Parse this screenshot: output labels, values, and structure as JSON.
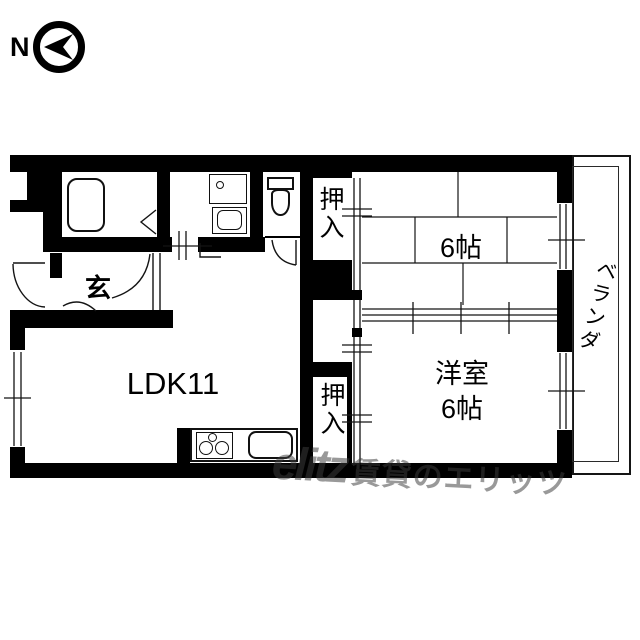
{
  "compass": {
    "north_label": "N"
  },
  "floorplan": {
    "rooms": {
      "closet_top": "押入",
      "tatami_room": "6帖",
      "entrance": "玄",
      "living_dining_kitchen": "LDK11",
      "western_room_name": "洋室",
      "western_room_size": "6帖",
      "closet_bottom": "押入",
      "balcony": "ベランダ"
    }
  },
  "watermark": {
    "logo": "elitz",
    "text": "賃貸のエリッツ"
  },
  "colors": {
    "wall": "#000000",
    "line": "#141414",
    "watermark_gray": "#3d3d3d",
    "background": "#ffffff"
  }
}
